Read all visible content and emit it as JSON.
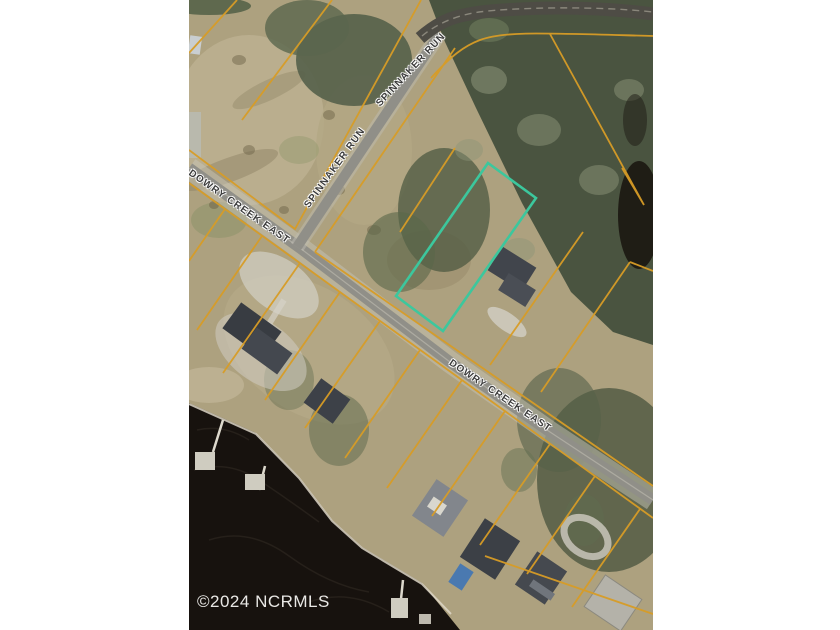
{
  "map": {
    "type": "aerial-parcel-map",
    "labels": {
      "spinnaker_run": "SPINNAKER RUN",
      "dowry_creek_east": "DOWRY CREEK EAST"
    },
    "watermark": "©2024 NCRMLS",
    "colors": {
      "page-bg": "#ffffff",
      "field": "#ada17f",
      "trees": "#4a5440",
      "water": "#17120e",
      "road": "#908f88",
      "road-dark": "#4e4c45",
      "parcel-line": "#d79c26",
      "highlight-parcel": "#3cc79d",
      "label-text": "#3c3c3c",
      "watermark-text": "#f5f4f1"
    }
  }
}
